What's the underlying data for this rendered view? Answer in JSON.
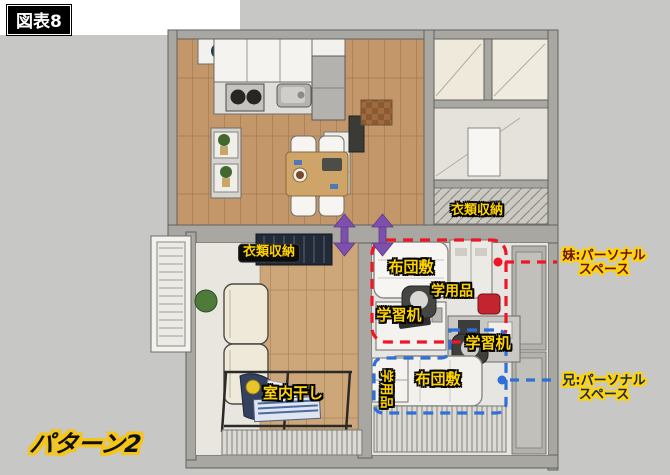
{
  "title_badge": "図表8",
  "pattern_label": "パターン2",
  "labels": {
    "closet_living": "衣類収納",
    "closet_hall": "衣類収納",
    "futon_sister": "布団敷",
    "supplies_sister": "学用品",
    "desk_sister": "学習机",
    "desk_brother": "学習机",
    "futon_brother": "布団敷",
    "supplies_brother": "学用品",
    "indoor_drying": "室内干し"
  },
  "callouts": {
    "sister": {
      "line1": "妹:パーソナル",
      "line2": "スペース",
      "zone_color": "#ef1626"
    },
    "brother": {
      "line1": "兄:パーソナル",
      "line2": "スペース",
      "zone_color": "#2f6fd6"
    }
  },
  "colors": {
    "background": "#c7c7c5",
    "label_yellow": "#ffd400",
    "sister_zone": "#ef1626",
    "brother_zone": "#2f6fd6",
    "move_arrow": "#7e50ae"
  }
}
